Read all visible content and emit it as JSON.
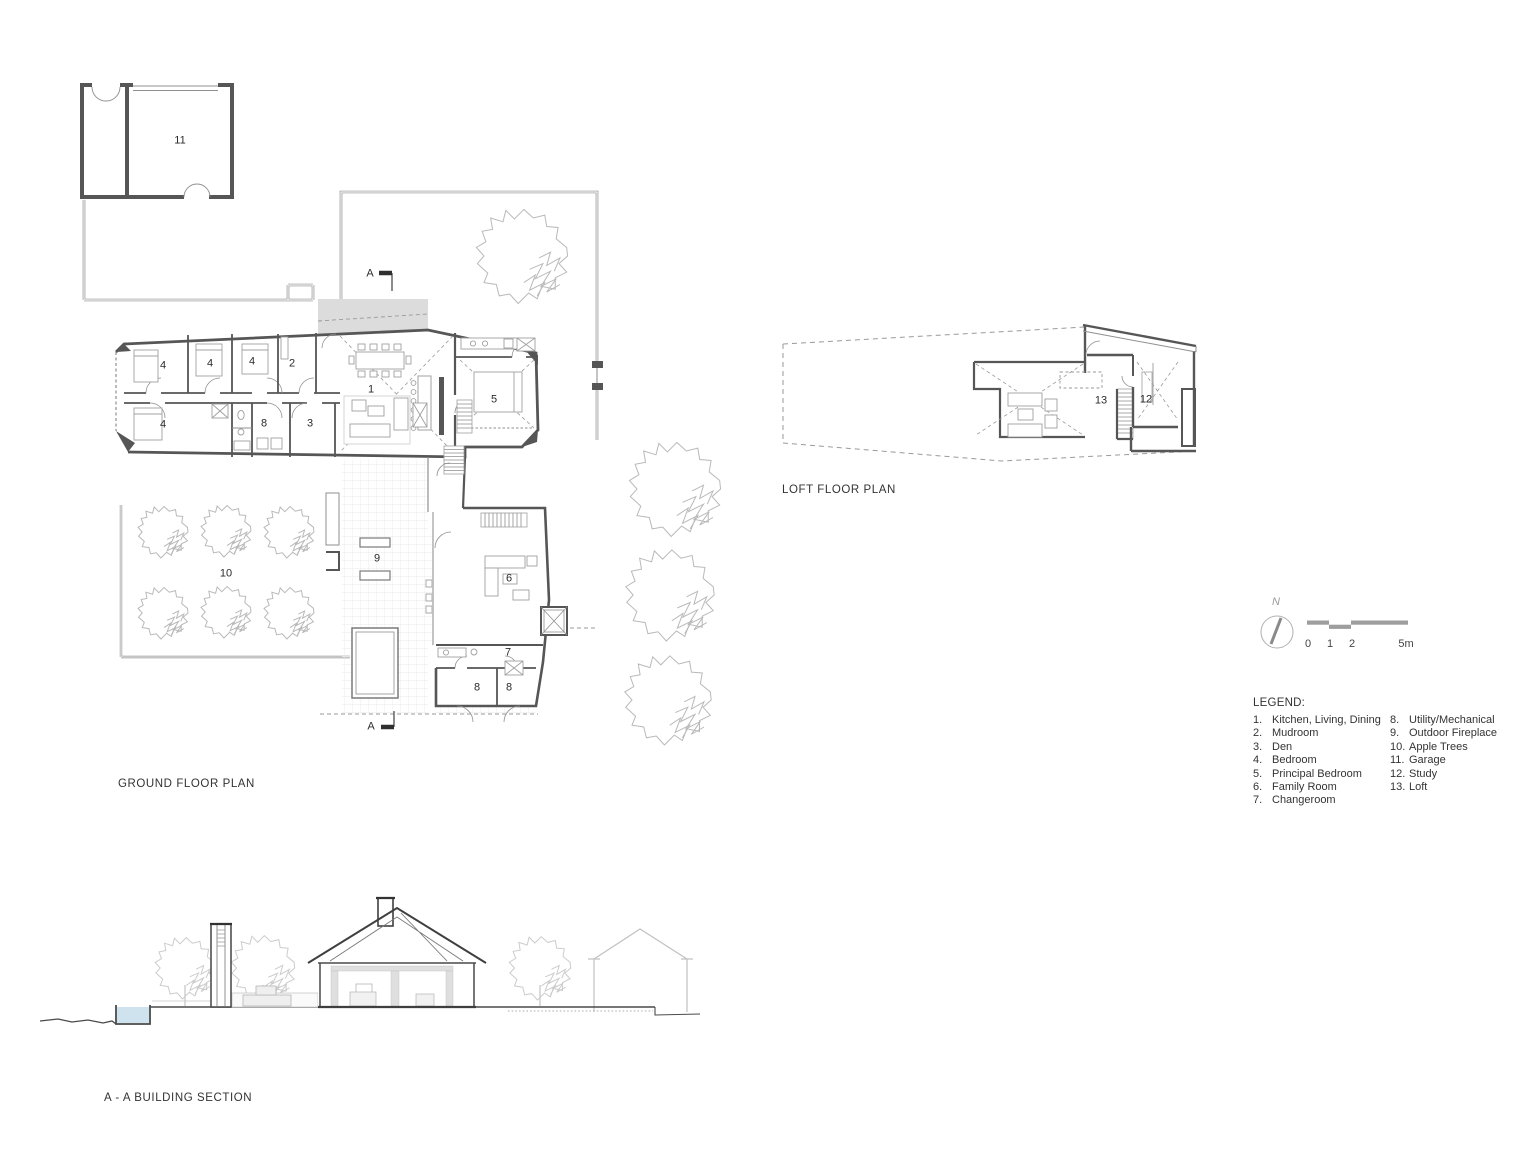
{
  "titles": {
    "ground": "GROUND FLOOR PLAN",
    "loft": "LOFT FLOOR PLAN",
    "section": "A - A BUILDING SECTION"
  },
  "legend": {
    "heading": "LEGEND:",
    "col1": [
      {
        "n": "1.",
        "label": "Kitchen, Living, Dining"
      },
      {
        "n": "2.",
        "label": "Mudroom"
      },
      {
        "n": "3.",
        "label": "Den"
      },
      {
        "n": "4.",
        "label": "Bedroom"
      },
      {
        "n": "5.",
        "label": "Principal Bedroom"
      },
      {
        "n": "6.",
        "label": "Family Room"
      },
      {
        "n": "7.",
        "label": "Changeroom"
      }
    ],
    "col2": [
      {
        "n": "8.",
        "label": "Utility/Mechanical"
      },
      {
        "n": "9.",
        "label": "Outdoor Fireplace"
      },
      {
        "n": "10.",
        "label": "Apple Trees"
      },
      {
        "n": "11.",
        "label": "Garage"
      },
      {
        "n": "12.",
        "label": "Study"
      },
      {
        "n": "13.",
        "label": "Loft"
      }
    ]
  },
  "scale": {
    "north": "N",
    "ticks": [
      "0",
      "1",
      "2",
      "5m"
    ]
  },
  "ground_plan": {
    "labels": [
      {
        "t": "11",
        "x": 180,
        "y": 141
      },
      {
        "t": "4",
        "x": 163,
        "y": 366
      },
      {
        "t": "4",
        "x": 210,
        "y": 364
      },
      {
        "t": "4",
        "x": 252,
        "y": 362
      },
      {
        "t": "2",
        "x": 292,
        "y": 364
      },
      {
        "t": "1",
        "x": 371,
        "y": 390
      },
      {
        "t": "5",
        "x": 494,
        "y": 400
      },
      {
        "t": "4",
        "x": 163,
        "y": 425
      },
      {
        "t": "8",
        "x": 264,
        "y": 424
      },
      {
        "t": "3",
        "x": 310,
        "y": 424
      },
      {
        "t": "9",
        "x": 377,
        "y": 559
      },
      {
        "t": "10",
        "x": 226,
        "y": 574
      },
      {
        "t": "6",
        "x": 509,
        "y": 579
      },
      {
        "t": "7",
        "x": 508,
        "y": 653
      },
      {
        "t": "8",
        "x": 477,
        "y": 688
      },
      {
        "t": "8",
        "x": 509,
        "y": 688
      },
      {
        "t": "A",
        "x": 370,
        "y": 274
      },
      {
        "t": "A",
        "x": 371,
        "y": 727
      }
    ]
  },
  "loft_plan": {
    "labels": [
      {
        "t": "13",
        "x": 1101,
        "y": 401
      },
      {
        "t": "12",
        "x": 1146,
        "y": 400
      }
    ]
  },
  "colors": {
    "wall": "#565656",
    "thin": "#8f8f8f",
    "furn": "#a0a0a0",
    "tree": "#b9b9b9",
    "tile": "#e4e4e4",
    "dash": "#9a9a9a",
    "ltgray": "#dcdcdc",
    "pool": "#cfe3ef",
    "sectree": "#cccccc",
    "faint": "#c2c2c2",
    "text": "#333333"
  }
}
